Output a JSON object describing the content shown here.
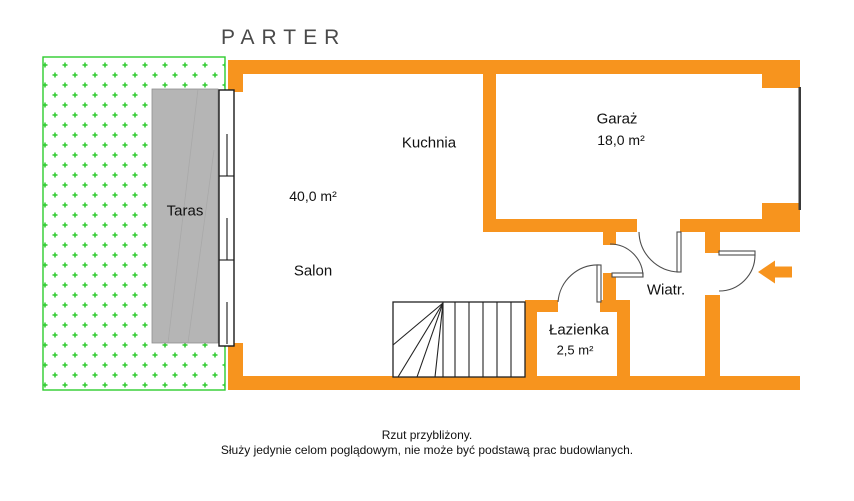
{
  "page": {
    "title": "PARTER"
  },
  "rooms": {
    "taras": {
      "label": "Taras"
    },
    "salon": {
      "label": "Salon",
      "area": "40,0 m²"
    },
    "kuchnia": {
      "label": "Kuchnia"
    },
    "garaz": {
      "label": "Garaż",
      "area": "18,0 m²"
    },
    "wiatrolap": {
      "label": "Wiatr."
    },
    "lazienka": {
      "label": "Łazienka",
      "area": "2,5 m²"
    }
  },
  "footer": {
    "line1": "Rzut przybliżony.",
    "line2": "Służy jedynie celom poglądowym, nie może być podstawą prac budowlanych."
  },
  "colors": {
    "wall_orange": "#F7941E",
    "grass_green": "#2ECC2E",
    "terrace_gray": "#B5B5B5",
    "title_gray": "#4A4A4A"
  },
  "icons": {
    "entrance_arrow": "arrow-left-icon"
  }
}
